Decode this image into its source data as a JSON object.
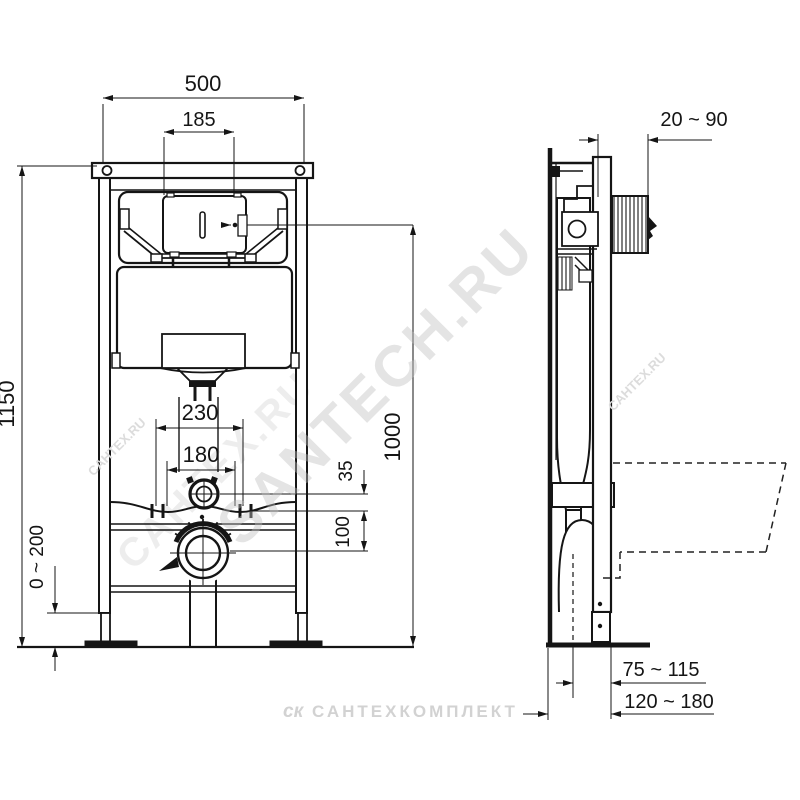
{
  "dims": {
    "frame_width": "500",
    "panel_width": "185",
    "frame_height": "1150",
    "foot_adjust": "0 ~ 200",
    "fixing_outer": "230",
    "fixing_inner": "180",
    "flush_offset": "35",
    "drain_offset": "100",
    "button_height": "1000",
    "wall_offset": "20 ~ 90",
    "drain_front": "75 ~ 115",
    "depth_range": "120 ~ 180"
  },
  "watermarks": {
    "main": "SANTECH.RU",
    "ghost": "САНТЕХ.RU",
    "side": "САНТЕХ.RU",
    "footer_logo": "ск",
    "footer_text": "САНТЕХКОМПЛЕКТ"
  }
}
